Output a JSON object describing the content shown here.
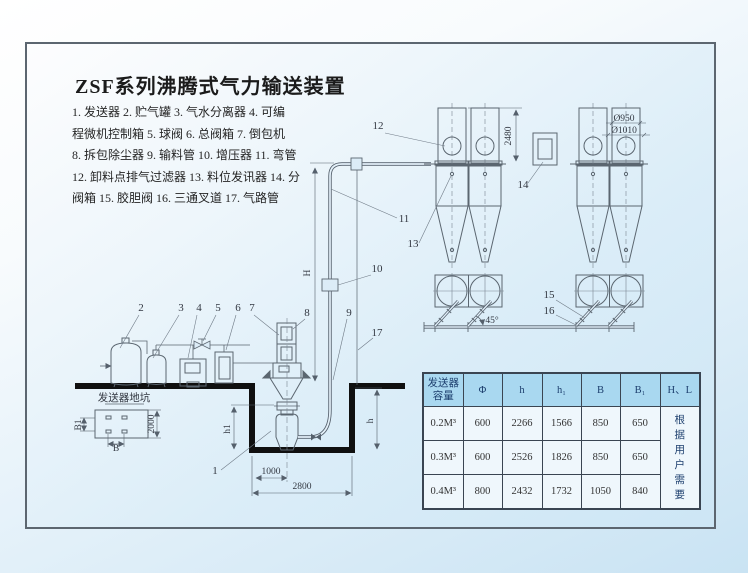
{
  "title": "ZSF系列沸腾式气力输送装置",
  "legend": {
    "lines": [
      "1. 发送器   2. 贮气罐   3. 气水分离器  4. 可编",
      "程微机控制箱   5. 球阀   6. 总阀箱   7. 倒包机",
      "8. 拆包除尘器  9. 输料管  10. 增压器 11. 弯管",
      "12. 卸料点排气过滤器  13. 料位发讯器  14. 分",
      "阀箱  15. 胶胆阀  16. 三通叉道  17. 气路管"
    ]
  },
  "diagram": {
    "callouts": {
      "c1": "1",
      "c2": "2",
      "c3": "3",
      "c4": "4",
      "c5": "5",
      "c6": "6",
      "c7": "7",
      "c8": "8",
      "c9": "9",
      "c10": "10",
      "c11": "11",
      "c12": "12",
      "c13": "13",
      "c14": "14",
      "c15": "15",
      "c16": "16",
      "c17": "17"
    },
    "labels": {
      "pit_plan": "发送器地坑",
      "angle": "45°"
    },
    "dims": {
      "v2480": "2480",
      "d950": "Ø950",
      "d1010": "Ø1010",
      "w1000": "1000",
      "w2800": "2800",
      "h2000": "2000",
      "B": "B",
      "B1": "B1",
      "h": "h",
      "h1": "h1",
      "H": "H"
    }
  },
  "table": {
    "headers": {
      "capacity": "发送器容量",
      "phi": "Φ",
      "h": "h",
      "h1": "h₁",
      "B": "B",
      "B1": "B₁",
      "HL": "H、L"
    },
    "rows": [
      {
        "cap": "0.2M³",
        "phi": "600",
        "h": "2266",
        "h1": "1566",
        "B": "850",
        "B1": "650"
      },
      {
        "cap": "0.3M³",
        "phi": "600",
        "h": "2526",
        "h1": "1826",
        "B": "850",
        "B1": "650"
      },
      {
        "cap": "0.4M³",
        "phi": "800",
        "h": "2432",
        "h1": "1732",
        "B": "1050",
        "B1": "840"
      }
    ],
    "note": "根据用户需要"
  }
}
